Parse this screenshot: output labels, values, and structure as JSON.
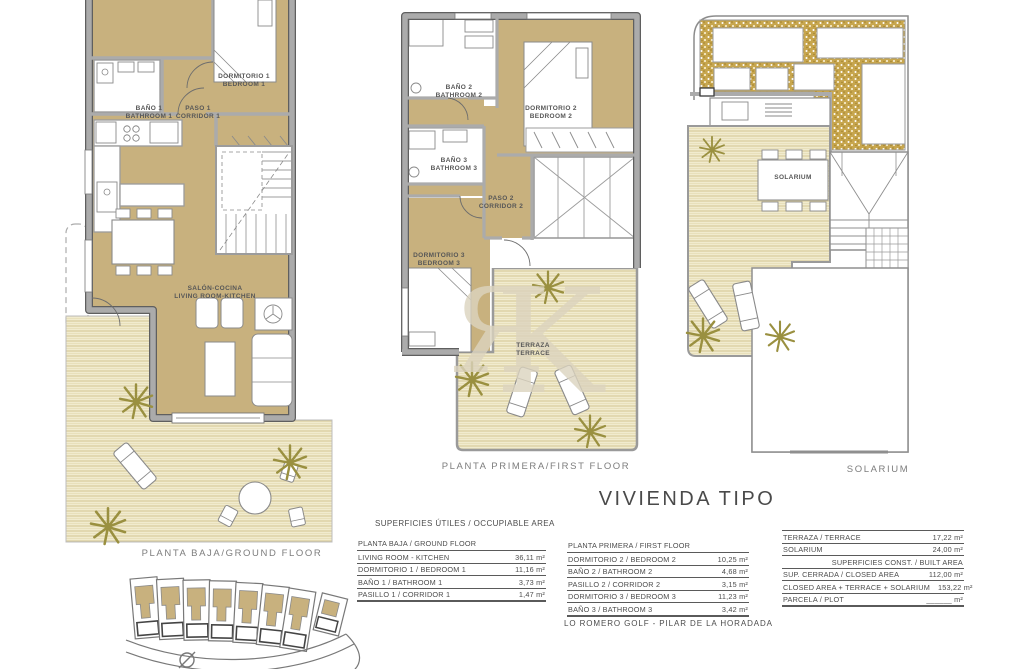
{
  "title": "VIVIENDA TIPO",
  "footer": "LO ROMERO GOLF  -  PILAR DE LA HORADADA",
  "watermark": {
    "letter_r": "Я",
    "letter_k": "K"
  },
  "plans": {
    "ground_floor": {
      "caption": "PLANTA BAJA/GROUND FLOOR",
      "labels": {
        "bedroom1": [
          "DORMITORIO 1",
          "BEDROOM 1"
        ],
        "bathroom1": [
          "BAÑO 1",
          "BATHROOM 1"
        ],
        "corridor1": [
          "PASO 1",
          "CORRIDOR 1"
        ],
        "living_room": [
          "SALÓN-COCINA",
          "LIVING ROOM-KITCHEN"
        ]
      }
    },
    "first_floor": {
      "caption": "PLANTA PRIMERA/FIRST FLOOR",
      "labels": {
        "bathroom2": [
          "BAÑO 2",
          "BATHROOM 2"
        ],
        "bedroom2": [
          "DORMITORIO 2",
          "BEDROOM 2"
        ],
        "bathroom3": [
          "BAÑO 3",
          "BATHROOM 3"
        ],
        "corridor2": [
          "PASO 2",
          "CORRIDOR 2"
        ],
        "bedroom3": [
          "DORMITORIO 3",
          "BEDROOM 3"
        ],
        "terrace": [
          "TERRAZA",
          "TERRACE"
        ]
      }
    },
    "solarium": {
      "caption": "SOLARIUM",
      "labels": {
        "solarium": [
          "SOLARIUM"
        ]
      }
    }
  },
  "tables": {
    "useful_header": "SUPERFICIES ÚTILES / OCCUPIABLE AREA",
    "ground": {
      "header": "PLANTA BAJA / GROUND FLOOR",
      "rows": [
        {
          "label": "LIVING ROOM - KITCHEN",
          "value": "36,11 m²"
        },
        {
          "label": "DORMITORIO 1 /  BEDROOM 1",
          "value": "11,16 m²"
        },
        {
          "label": "BAÑO 1 / BATHROOM 1",
          "value": "3,73 m²"
        },
        {
          "label": "PASILLO 1 / CORRIDOR 1",
          "value": "1,47 m²"
        }
      ]
    },
    "first": {
      "header": "PLANTA PRIMERA / FIRST FLOOR",
      "rows": [
        {
          "label": "DORMITORIO 2 / BEDROOM 2",
          "value": "10,25 m²"
        },
        {
          "label": "BAÑO 2 / BATHROOM 2",
          "value": "4,68 m²"
        },
        {
          "label": "PASILLO 2 / CORRIDOR 2",
          "value": "3,15 m²"
        },
        {
          "label": "DORMITORIO 3 / BEDROOM 3",
          "value": "11,23 m²"
        },
        {
          "label": "BAÑO 3 / BATHROOM 3",
          "value": "3,42 m²"
        }
      ]
    },
    "built": {
      "rows_top": [
        {
          "label": "TERRAZA / TERRACE",
          "value": "17,22 m²"
        },
        {
          "label": "SOLARIUM",
          "value": "24,00 m²"
        }
      ],
      "subheader": "SUPERFICIES  CONST. / BUILT AREA",
      "rows_bottom": [
        {
          "label": "SUP. CERRADA / CLOSED AREA",
          "value": "112,00 m²"
        },
        {
          "label": "CLOSED AREA + TERRACE + SOLARIUM",
          "value": "153,22 m²"
        },
        {
          "label": "PARCELA / PLOT",
          "value": "______ m²"
        }
      ]
    }
  },
  "colors": {
    "room_tan": "#C8B17E",
    "stripe_bg": "#F1EBCE",
    "stripe_line": "#D8CB9B",
    "speckle_gold": "#C7A64E",
    "wall_gray": "#ABABAB",
    "wall_dark": "#5F5F5F",
    "palm_green": "#9A9040"
  }
}
